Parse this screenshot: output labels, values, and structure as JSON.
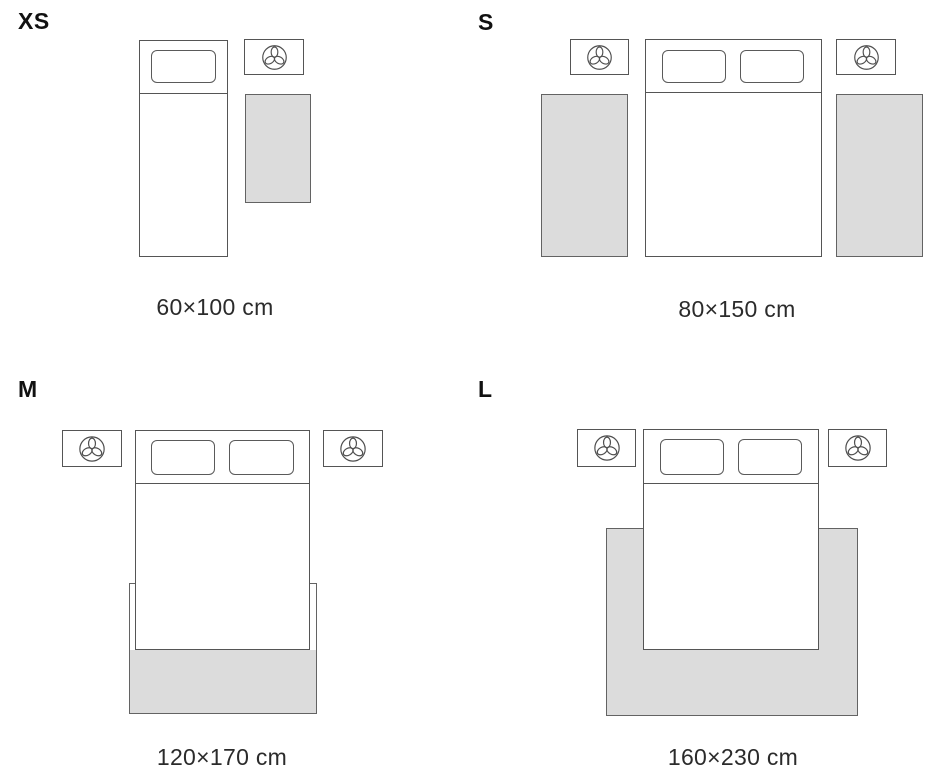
{
  "diagram": {
    "kind": "rug-size-guide",
    "colors": {
      "background": "#ffffff",
      "outline": "#555555",
      "rug_fill": "#dcdcdc",
      "rug_border": "#636363",
      "label_text": "#111111",
      "caption_text": "#2b2b2b"
    },
    "icon": "plant-icon"
  },
  "sizes": [
    {
      "label": "XS",
      "dimensions": "60×100 cm",
      "scene": "single bed, one nightstand with plant, rug beside bed"
    },
    {
      "label": "S",
      "dimensions": "80×150 cm",
      "scene": "double bed, two nightstands with plants, one rug on each side of bed"
    },
    {
      "label": "M",
      "dimensions": "120×170 cm",
      "scene": "double bed, two nightstands with plants, rug under foot of bed"
    },
    {
      "label": "L",
      "dimensions": "160×230 cm",
      "scene": "double bed, two nightstands with plants, large rug under bed extending on three sides"
    }
  ]
}
